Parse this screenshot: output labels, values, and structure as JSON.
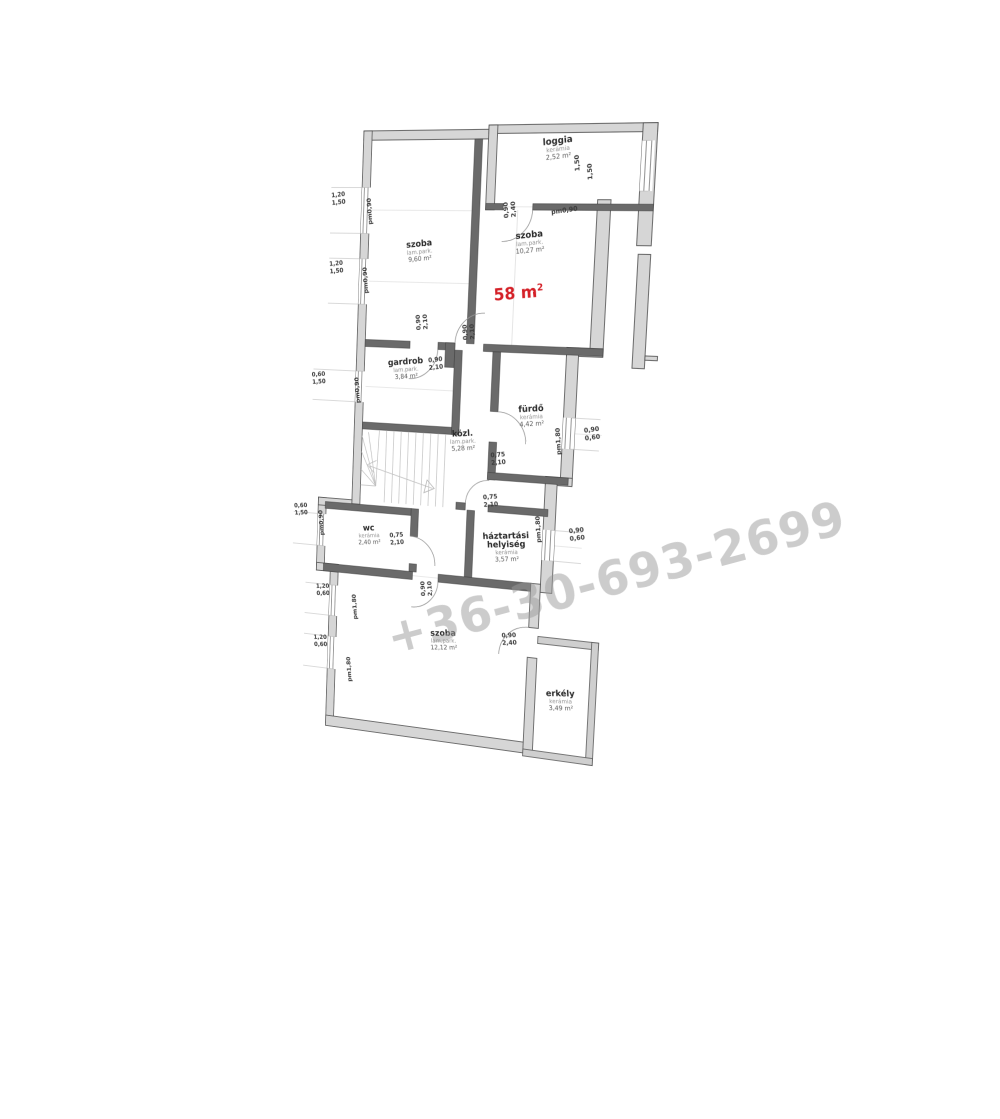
{
  "watermark": {
    "text": "+36-30-693-2699"
  },
  "palette": {
    "accent_red": "#d42027",
    "wall_outer_fill": "#d6d6d6",
    "wall_inner_fill": "#6a6a6a",
    "balcony_fill": "#cfcfcf",
    "dim_text": "#3a3a3a",
    "room_name": "#2a2a2a",
    "room_sub": "#8f8f8f",
    "room_area": "#555555"
  },
  "plan": {
    "total_area": {
      "value": "58 m",
      "sup": "2",
      "x": 170,
      "y": 160
    },
    "rooms": [
      {
        "id": "szoba-1",
        "name_lines": [
          "szoba"
        ],
        "floor": "lam.park.",
        "area": "9,60 m²",
        "x": 64,
        "y": 112
      },
      {
        "id": "szoba-2",
        "name_lines": [
          "szoba"
        ],
        "floor": "lam.park.",
        "area": "10,27 m²",
        "x": 178,
        "y": 102
      },
      {
        "id": "loggia",
        "name_lines": [
          "loggia"
        ],
        "floor": "kerámia",
        "area": "2,52 m²",
        "x": 202,
        "y": 14
      },
      {
        "id": "gardrob",
        "name_lines": [
          "gardrob"
        ],
        "floor": "lam.park.",
        "area": "3,84 m²",
        "x": 54,
        "y": 228
      },
      {
        "id": "kozl",
        "name_lines": [
          "közl."
        ],
        "floor": "lam.park.",
        "area": "5,28 m²",
        "x": 118,
        "y": 296
      },
      {
        "id": "furdo",
        "name_lines": [
          "fürdő"
        ],
        "floor": "kerámia",
        "area": "4,42 m²",
        "x": 188,
        "y": 268
      },
      {
        "id": "wc",
        "name_lines": [
          "wc"
        ],
        "floor": "kerámia",
        "area": "2,40 m²",
        "x": 20,
        "y": 398
      },
      {
        "id": "haztartasi",
        "name_lines": [
          "háztartási",
          "helyiség"
        ],
        "floor": "kerámia",
        "area": "3,57 m²",
        "x": 168,
        "y": 394
      },
      {
        "id": "szoba-3",
        "name_lines": [
          "szoba"
        ],
        "floor": "lam.park.",
        "area": "12,12 m²",
        "x": 106,
        "y": 498
      },
      {
        "id": "erkely",
        "name_lines": [
          "erkély"
        ],
        "floor": "kerámia",
        "area": "3,49 m²",
        "x": 232,
        "y": 545
      }
    ],
    "dimensions": [
      {
        "lines": [
          "1,20",
          "1,50"
        ],
        "x": -26,
        "y": 64,
        "rot": -6
      },
      {
        "lines": [
          "1,20",
          "1,50"
        ],
        "x": -26,
        "y": 132,
        "rot": -6
      },
      {
        "lines": [
          "0,60",
          "1,50"
        ],
        "x": -42,
        "y": 244,
        "rot": -6
      },
      {
        "lines": [
          "0,60",
          "1,50"
        ],
        "x": -58,
        "y": 380,
        "rot": -6
      },
      {
        "lines": [
          "1,20",
          "0,60"
        ],
        "x": -30,
        "y": 462,
        "rot": -6
      },
      {
        "lines": [
          "1,20",
          "0,60"
        ],
        "x": -31,
        "y": 516,
        "rot": -6
      },
      {
        "lines": [
          "pm0,90"
        ],
        "x": 11,
        "y": 78,
        "rot": -96
      },
      {
        "lines": [
          "pm0,90"
        ],
        "x": 9,
        "y": 146,
        "rot": -96
      },
      {
        "lines": [
          "pm0,90"
        ],
        "x": 4,
        "y": 256,
        "rot": -96
      },
      {
        "lines": [
          "pm0,90"
        ],
        "x": -32,
        "y": 394,
        "rot": -96
      },
      {
        "lines": [
          "pm1,80"
        ],
        "x": 9,
        "y": 478,
        "rot": -96
      },
      {
        "lines": [
          "pm1,80"
        ],
        "x": 5,
        "y": 544,
        "rot": -96
      },
      {
        "lines": [
          "pm1,80"
        ],
        "x": 219,
        "y": 295,
        "rot": -96
      },
      {
        "lines": [
          "pm1,80"
        ],
        "x": 203,
        "y": 382,
        "rot": -96
      },
      {
        "lines": [
          "0,90",
          "0,60"
        ],
        "x": 250,
        "y": 284,
        "rot": -10
      },
      {
        "lines": [
          "0,90",
          "0,60"
        ],
        "x": 240,
        "y": 382,
        "rot": -10
      },
      {
        "lines": [
          "1,50"
        ],
        "x": 224,
        "y": 32,
        "rot": -96
      },
      {
        "lines": [
          "1,50"
        ],
        "x": 237,
        "y": 40,
        "rot": -96
      },
      {
        "lines": [
          "pm0,90"
        ],
        "x": 212,
        "y": 78,
        "rot": -8
      },
      {
        "lines": [
          "0,90",
          "2,40"
        ],
        "x": 155,
        "y": 76,
        "rot": -96
      },
      {
        "lines": [
          "0,90",
          "2,10"
        ],
        "x": 68,
        "y": 186,
        "rot": -96
      },
      {
        "lines": [
          "0,90",
          "2,10"
        ],
        "x": 118,
        "y": 194,
        "rot": -96
      },
      {
        "lines": [
          "0,90",
          "2,10"
        ],
        "x": 86,
        "y": 224,
        "rot": -8
      },
      {
        "lines": [
          "0,75",
          "2,10"
        ],
        "x": 156,
        "y": 314,
        "rot": -8
      },
      {
        "lines": [
          "0,75",
          "2,10"
        ],
        "x": 150,
        "y": 356,
        "rot": -8
      },
      {
        "lines": [
          "0,75",
          "2,10"
        ],
        "x": 51,
        "y": 402,
        "rot": -8
      },
      {
        "lines": [
          "0,90",
          "2,10"
        ],
        "x": 84,
        "y": 452,
        "rot": -96
      },
      {
        "lines": [
          "0,90",
          "2,40"
        ],
        "x": 176,
        "y": 492,
        "rot": -8
      }
    ]
  }
}
